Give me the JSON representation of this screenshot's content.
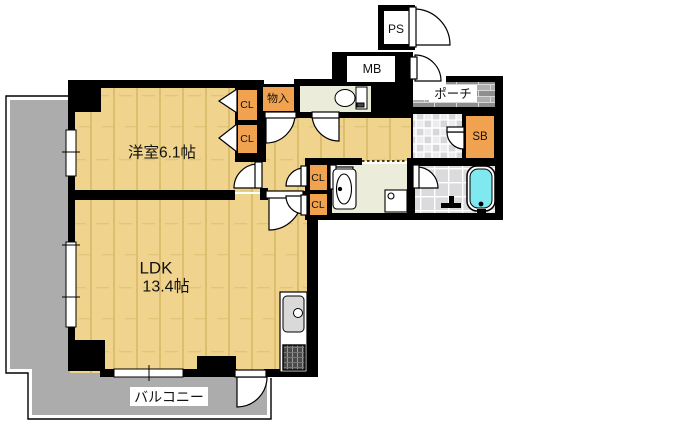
{
  "plan_labels": {
    "western_room": "洋室6.1帖",
    "ldk_line1": "LDK",
    "ldk_line2": "13.4帖",
    "balcony": "バルコニー",
    "porch": "ポーチ",
    "pipe_space": "PS",
    "meter_box": "MB",
    "shoe_box": "SB",
    "storage": "物入",
    "closet_1": "CL",
    "closet_2": "CL",
    "closet_3": "CL",
    "closet_4": "CL"
  },
  "colors": {
    "closet_orange": "#F0A24F",
    "wood_floor": "#F0D38C",
    "bathtub_cyan": "#7FE9EF",
    "balcony_gray": "#ACACAC",
    "mat_green": "#EBEDDA",
    "wall_black": "#000000"
  }
}
